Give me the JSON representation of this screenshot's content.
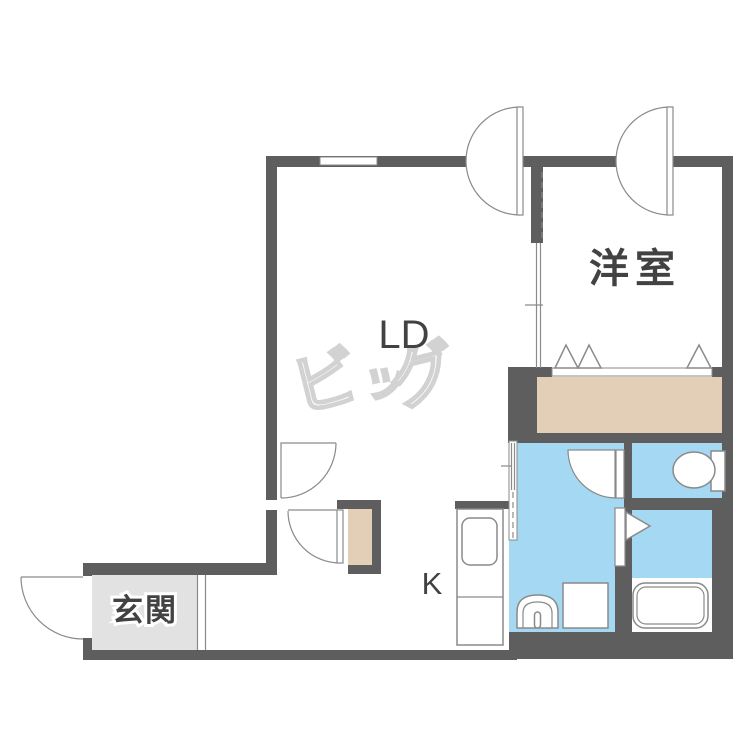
{
  "plan": {
    "rooms": {
      "living_dining": "LD",
      "western_room": "洋室",
      "kitchen": "K",
      "entrance": "玄関"
    }
  },
  "watermark": {
    "chars": [
      "ビ",
      "ッ",
      "グ"
    ]
  },
  "colors": {
    "wall": "#5e5e5e",
    "water_blue": "#a5d8f2",
    "closet_beige": "#e3cfb7",
    "genkan_gray": "#e2e2e2",
    "line": "#8a8a8a",
    "label_text": "#424242",
    "watermark_gray": "#d2d2d2"
  }
}
